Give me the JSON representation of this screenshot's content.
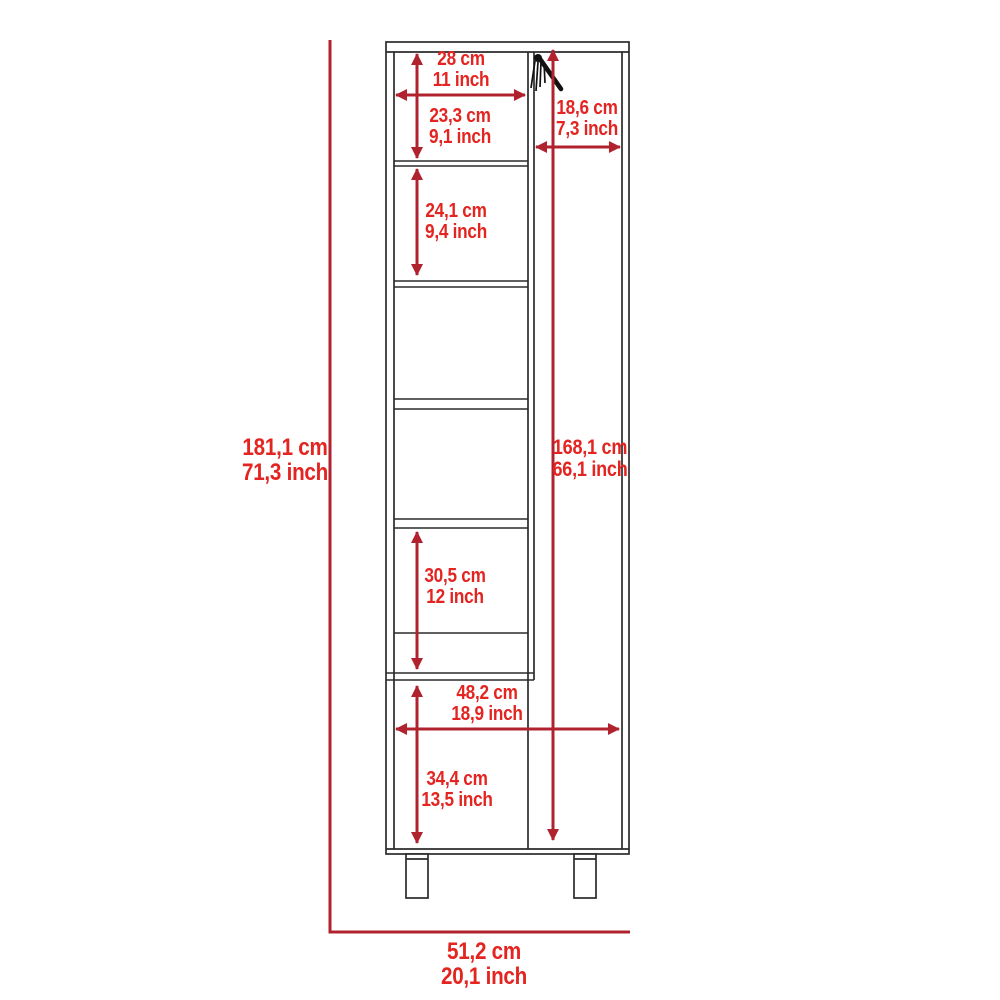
{
  "colors": {
    "dimension_text": "#e32420",
    "dimension_line": "#b0232e",
    "cabinet_line": "#2b2b2b",
    "background": "#ffffff"
  },
  "diagram": {
    "kind": "furniture-dimension-drawing",
    "icon": "broom-hanger-icon",
    "units": [
      "cm",
      "inch"
    ]
  },
  "dims": {
    "top_shelf_width": {
      "cm": "28 cm",
      "inch": "11 inch"
    },
    "top_shelf_height": {
      "cm": "23,3 cm",
      "inch": "9,1 inch"
    },
    "side_compartment_width": {
      "cm": "18,6 cm",
      "inch": "7,3 inch"
    },
    "second_shelf_height": {
      "cm": "24,1 cm",
      "inch": "9,4 inch"
    },
    "overall_height": {
      "cm": "181,1 cm",
      "inch": "71,3 inch"
    },
    "side_compartment_height": {
      "cm": "168,1 cm",
      "inch": "66,1 inch"
    },
    "fifth_shelf_height": {
      "cm": "30,5 cm",
      "inch": "12 inch"
    },
    "lower_section_width": {
      "cm": "48,2 cm",
      "inch": "18,9 inch"
    },
    "lower_section_height": {
      "cm": "34,4 cm",
      "inch": "13,5 inch"
    },
    "overall_width": {
      "cm": "51,2 cm",
      "inch": "20,1 inch"
    }
  }
}
